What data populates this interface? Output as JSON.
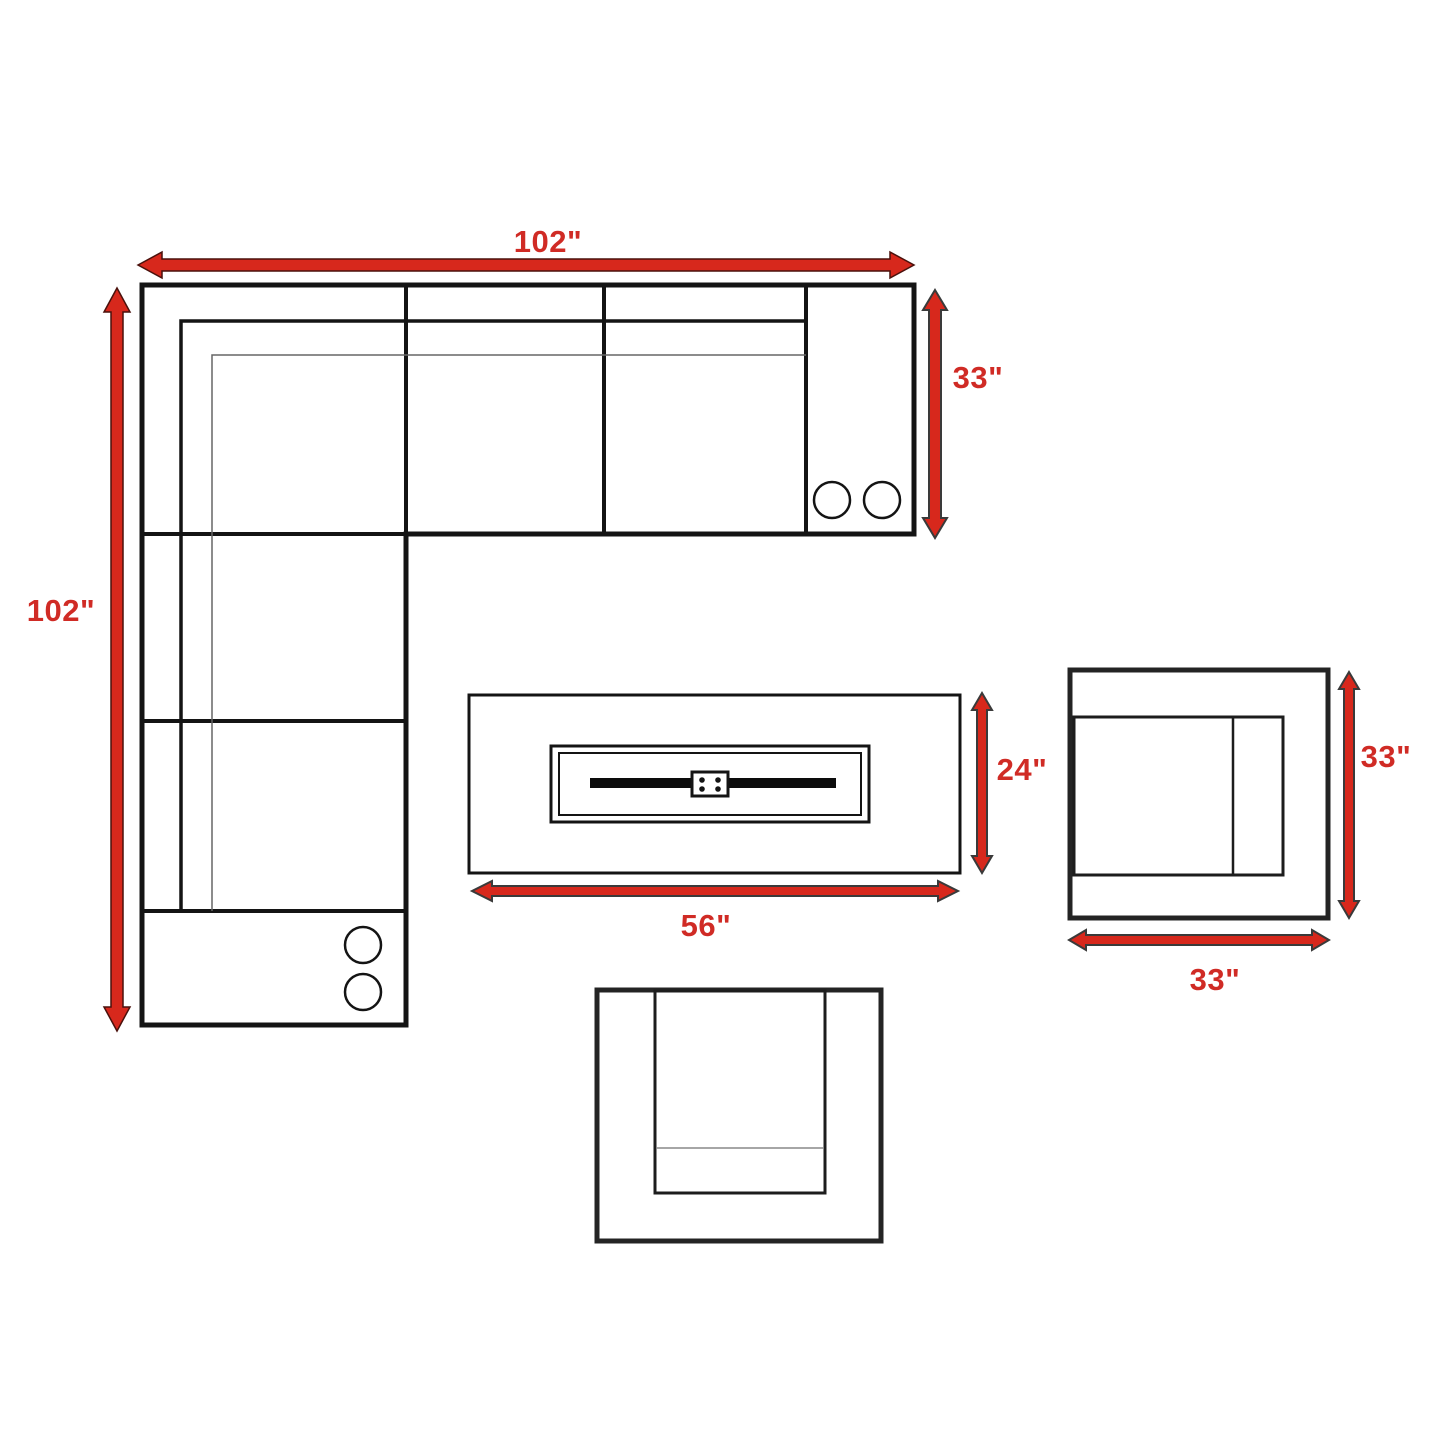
{
  "diagram": {
    "kind": "furniture-dimension-floorplan",
    "background_color": "#ffffff",
    "outline_color": "#141414",
    "arrow_color": "#d7281c",
    "label_color": "#d02b25",
    "figures": [
      {
        "name": "l-shaped-sectional-sofa",
        "features": [
          "three-top-seats",
          "two-side-seats",
          "two-armrest-consoles-with-two-cup-holders-each"
        ]
      },
      {
        "name": "rectangular-fire-pit-table",
        "features": [
          "center-burner-tray",
          "burner-bar",
          "igniter-plate-four-bolts"
        ]
      },
      {
        "name": "side-chair-right",
        "features": [
          "seat-with-back-cushion-line"
        ]
      },
      {
        "name": "side-chair-bottom",
        "features": [
          "seat-with-front-cushion-line"
        ]
      }
    ],
    "dimensions": {
      "sectional": {
        "width": "102\"",
        "depth": "102\"",
        "section_depth": "33\""
      },
      "fire_pit_table": {
        "width": "56\"",
        "depth": "24\""
      },
      "side_chair": {
        "width": "33\"",
        "depth": "33\""
      }
    }
  }
}
